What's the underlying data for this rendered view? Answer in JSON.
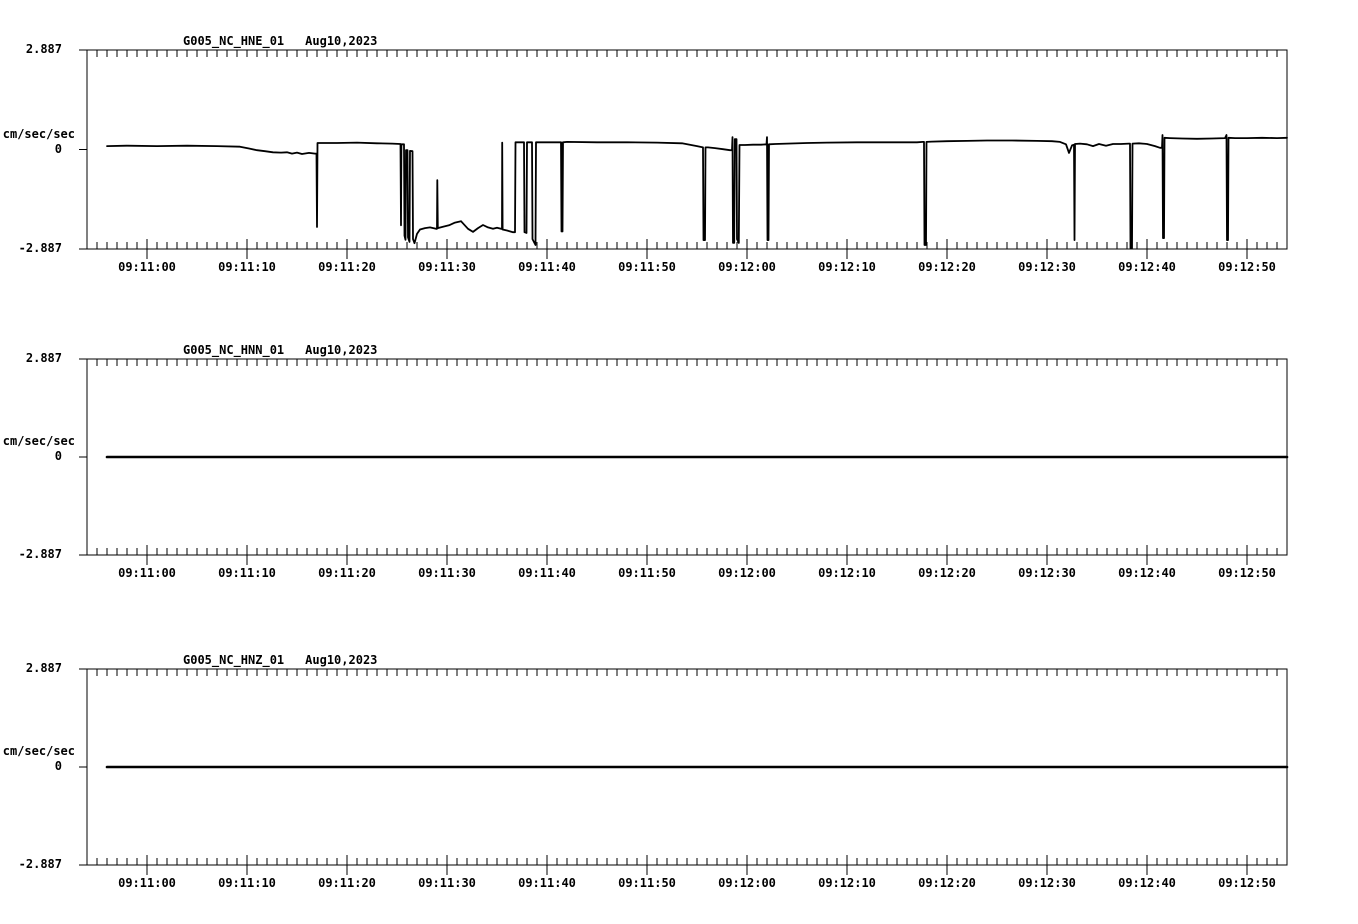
{
  "page": {
    "background_color": "#ffffff",
    "ink_color": "#000000"
  },
  "chart_data": [
    {
      "type": "line",
      "title": "G005_NC_HNE_01",
      "date": "Aug10,2023",
      "ylabel": "cm/sec/sec",
      "y_tick_labels": [
        "2.887",
        "0",
        "-2.887"
      ],
      "ylim": [
        -2.887,
        2.887
      ],
      "x_tick_labels": [
        "09:11:00",
        "09:11:10",
        "09:11:20",
        "09:11:30",
        "09:11:40",
        "09:11:50",
        "09:12:00",
        "09:12:10",
        "09:12:20",
        "09:12:30",
        "09:12:40",
        "09:12:50"
      ],
      "x_first_tick_s": 6,
      "x_tick_interval_s": 10,
      "x_minor_tick_interval_s": 1,
      "x_span_s": 120,
      "grid": false,
      "legend": false,
      "series": [
        {
          "name": "HNE acceleration trace",
          "units": "cm/sec/sec",
          "points_t_s_value": [
            [
              2,
              0.1
            ],
            [
              4,
              0.11
            ],
            [
              7,
              0.1
            ],
            [
              10,
              0.11
            ],
            [
              13,
              0.1
            ],
            [
              15.3,
              0.08
            ],
            [
              16.2,
              0.03
            ],
            [
              17.0,
              -0.02
            ],
            [
              17.8,
              -0.05
            ],
            [
              18.6,
              -0.08
            ],
            [
              19.4,
              -0.09
            ],
            [
              20.0,
              -0.08
            ],
            [
              20.5,
              -0.12
            ],
            [
              21.0,
              -0.09
            ],
            [
              21.5,
              -0.13
            ],
            [
              22.2,
              -0.1
            ],
            [
              22.8,
              -0.12
            ],
            [
              22.95,
              -0.12
            ],
            [
              23.0,
              -2.25
            ],
            [
              23.05,
              0.19
            ],
            [
              23.5,
              0.19
            ],
            [
              25,
              0.19
            ],
            [
              27,
              0.2
            ],
            [
              29,
              0.18
            ],
            [
              30.5,
              0.17
            ],
            [
              31.35,
              0.16
            ],
            [
              31.4,
              -2.2
            ],
            [
              31.44,
              0.15
            ],
            [
              31.7,
              0.15
            ],
            [
              31.75,
              -2.5
            ],
            [
              31.85,
              -2.62
            ],
            [
              31.9,
              -0.02
            ],
            [
              32.05,
              -0.02
            ],
            [
              32.1,
              -2.55
            ],
            [
              32.25,
              -2.68
            ],
            [
              32.3,
              -0.04
            ],
            [
              32.55,
              -0.05
            ],
            [
              32.6,
              -2.6
            ],
            [
              32.75,
              -2.72
            ],
            [
              33.0,
              -2.45
            ],
            [
              33.3,
              -2.32
            ],
            [
              33.8,
              -2.28
            ],
            [
              34.3,
              -2.26
            ],
            [
              34.9,
              -2.3
            ],
            [
              35.0,
              -2.3
            ],
            [
              35.03,
              -0.89
            ],
            [
              35.08,
              -2.28
            ],
            [
              35.6,
              -2.24
            ],
            [
              36.2,
              -2.2
            ],
            [
              36.8,
              -2.12
            ],
            [
              37.4,
              -2.08
            ],
            [
              38.1,
              -2.3
            ],
            [
              38.6,
              -2.39
            ],
            [
              39.1,
              -2.28
            ],
            [
              39.6,
              -2.19
            ],
            [
              40.1,
              -2.26
            ],
            [
              40.6,
              -2.3
            ],
            [
              41.0,
              -2.27
            ],
            [
              41.4,
              -2.3
            ],
            [
              41.5,
              -2.3
            ],
            [
              41.52,
              0.2
            ],
            [
              41.56,
              -2.32
            ],
            [
              42.0,
              -2.35
            ],
            [
              42.6,
              -2.4
            ],
            [
              42.8,
              -2.4
            ],
            [
              42.85,
              0.21
            ],
            [
              43.7,
              0.21
            ],
            [
              43.75,
              -2.4
            ],
            [
              43.95,
              -2.42
            ],
            [
              44.0,
              0.21
            ],
            [
              44.5,
              0.21
            ],
            [
              44.55,
              -2.6
            ],
            [
              44.85,
              -2.77
            ],
            [
              44.9,
              0.21
            ],
            [
              45.5,
              0.21
            ],
            [
              47.4,
              0.21
            ],
            [
              47.45,
              -2.38
            ],
            [
              47.5,
              0.2
            ],
            [
              47.55,
              -2.38
            ],
            [
              47.6,
              0.21
            ],
            [
              48,
              0.22
            ],
            [
              51,
              0.21
            ],
            [
              54,
              0.21
            ],
            [
              57,
              0.2
            ],
            [
              59.5,
              0.18
            ],
            [
              61.0,
              0.1
            ],
            [
              61.6,
              0.06
            ],
            [
              61.65,
              -2.63
            ],
            [
              61.8,
              -2.63
            ],
            [
              61.85,
              0.06
            ],
            [
              62.1,
              0.06
            ],
            [
              62.8,
              0.04
            ],
            [
              63.6,
              0.01
            ],
            [
              64.3,
              -0.02
            ],
            [
              64.5,
              -0.02
            ],
            [
              64.55,
              0.36
            ],
            [
              64.6,
              -2.71
            ],
            [
              64.72,
              -2.71
            ],
            [
              64.78,
              0.3
            ],
            [
              64.95,
              0.3
            ],
            [
              65.0,
              -2.6
            ],
            [
              65.18,
              -2.71
            ],
            [
              65.25,
              0.13
            ],
            [
              65.8,
              0.13
            ],
            [
              66.6,
              0.14
            ],
            [
              67.4,
              0.14
            ],
            [
              67.95,
              0.15
            ],
            [
              68.0,
              0.36
            ],
            [
              68.05,
              -2.63
            ],
            [
              68.1,
              0.14
            ],
            [
              68.15,
              -2.63
            ],
            [
              68.2,
              0.15
            ],
            [
              68.8,
              0.16
            ],
            [
              70,
              0.17
            ],
            [
              72,
              0.19
            ],
            [
              74,
              0.2
            ],
            [
              77,
              0.21
            ],
            [
              80,
              0.21
            ],
            [
              83,
              0.21
            ],
            [
              83.6,
              0.22
            ],
            [
              83.7,
              0.22
            ],
            [
              83.75,
              -2.77
            ],
            [
              83.9,
              -2.77
            ],
            [
              83.95,
              0.22
            ],
            [
              84.5,
              0.23
            ],
            [
              86,
              0.24
            ],
            [
              88,
              0.25
            ],
            [
              90,
              0.26
            ],
            [
              92.5,
              0.26
            ],
            [
              95,
              0.25
            ],
            [
              96.5,
              0.24
            ],
            [
              97.3,
              0.22
            ],
            [
              97.9,
              0.15
            ],
            [
              98.2,
              -0.1
            ],
            [
              98.5,
              0.12
            ],
            [
              98.7,
              0.14
            ],
            [
              98.75,
              -2.63
            ],
            [
              98.8,
              0.16
            ],
            [
              99.3,
              0.17
            ],
            [
              100,
              0.15
            ],
            [
              100.6,
              0.1
            ],
            [
              101.2,
              0.16
            ],
            [
              101.9,
              0.11
            ],
            [
              102.6,
              0.16
            ],
            [
              103.4,
              0.16
            ],
            [
              104.2,
              0.17
            ],
            [
              104.3,
              0.17
            ],
            [
              104.35,
              -2.86
            ],
            [
              104.5,
              -2.86
            ],
            [
              104.55,
              0.17
            ],
            [
              105.2,
              0.18
            ],
            [
              106,
              0.16
            ],
            [
              106.8,
              0.1
            ],
            [
              107.3,
              0.05
            ],
            [
              107.5,
              0.05
            ],
            [
              107.55,
              0.42
            ],
            [
              107.6,
              -2.57
            ],
            [
              107.7,
              -2.57
            ],
            [
              107.75,
              0.34
            ],
            [
              108.3,
              0.33
            ],
            [
              109.5,
              0.32
            ],
            [
              111,
              0.31
            ],
            [
              112.5,
              0.32
            ],
            [
              113.8,
              0.33
            ],
            [
              113.95,
              0.42
            ],
            [
              114.0,
              -2.63
            ],
            [
              114.1,
              -2.63
            ],
            [
              114.15,
              0.34
            ],
            [
              114.8,
              0.33
            ],
            [
              116,
              0.33
            ],
            [
              117.5,
              0.34
            ],
            [
              119,
              0.33
            ],
            [
              120,
              0.34
            ]
          ]
        }
      ]
    },
    {
      "type": "line",
      "title": "G005_NC_HNN_01",
      "date": "Aug10,2023",
      "ylabel": "cm/sec/sec",
      "y_tick_labels": [
        "2.887",
        "0",
        "-2.887"
      ],
      "ylim": [
        -2.887,
        2.887
      ],
      "x_tick_labels": [
        "09:11:00",
        "09:11:10",
        "09:11:20",
        "09:11:30",
        "09:11:40",
        "09:11:50",
        "09:12:00",
        "09:12:10",
        "09:12:20",
        "09:12:30",
        "09:12:40",
        "09:12:50"
      ],
      "x_first_tick_s": 6,
      "x_tick_interval_s": 10,
      "x_minor_tick_interval_s": 1,
      "x_span_s": 120,
      "grid": false,
      "legend": false,
      "series": [
        {
          "name": "HNN acceleration trace (flat)",
          "units": "cm/sec/sec",
          "points_t_s_value": [
            [
              2,
              0
            ],
            [
              120,
              0
            ]
          ]
        }
      ]
    },
    {
      "type": "line",
      "title": "G005_NC_HNZ_01",
      "date": "Aug10,2023",
      "ylabel": "cm/sec/sec",
      "y_tick_labels": [
        "2.887",
        "0",
        "-2.887"
      ],
      "ylim": [
        -2.887,
        2.887
      ],
      "x_tick_labels": [
        "09:11:00",
        "09:11:10",
        "09:11:20",
        "09:11:30",
        "09:11:40",
        "09:11:50",
        "09:12:00",
        "09:12:10",
        "09:12:20",
        "09:12:30",
        "09:12:40",
        "09:12:50"
      ],
      "x_first_tick_s": 6,
      "x_tick_interval_s": 10,
      "x_minor_tick_interval_s": 1,
      "x_span_s": 120,
      "grid": false,
      "legend": false,
      "series": [
        {
          "name": "HNZ acceleration trace (flat)",
          "units": "cm/sec/sec",
          "points_t_s_value": [
            [
              2,
              0
            ],
            [
              120,
              0
            ]
          ]
        }
      ]
    }
  ]
}
